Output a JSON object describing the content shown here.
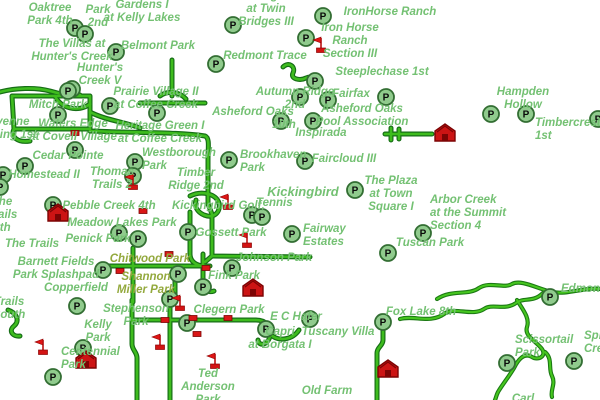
{
  "map": {
    "background": "#ffffff",
    "label_color": "#74c173",
    "label_color_olive": "#93a93d",
    "road_core_color": "#3ebc1e",
    "road_casing_color": "#166e16",
    "parking_icon": {
      "glyph": "P",
      "fill": "#90cb8d",
      "border": "#336e33",
      "letter_color": "#0a0a0a"
    },
    "marker_red": "#d91717",
    "marker_dark_red": "#7c0404",
    "labels": [
      {
        "text": "Oaktree\nPark 4th",
        "x": 50,
        "y": 2
      },
      {
        "text": "Oaktree\nPark\n2nd",
        "x": 98,
        "y": -9
      },
      {
        "text": "Gardens I\nat Kelly Lakes",
        "x": 142,
        "y": -1
      },
      {
        "text": "Village\nat Twin\nBridges III",
        "x": 266,
        "y": -10
      },
      {
        "text": "IronHorse Ranch",
        "x": 390,
        "y": 6
      },
      {
        "text": "The Villas at\nHunter's Creek",
        "x": 72,
        "y": 38
      },
      {
        "text": "Belmont Park",
        "x": 158,
        "y": 40
      },
      {
        "text": "Iron Horse\nRanch\nSection III",
        "x": 350,
        "y": 22
      },
      {
        "text": "Redmont Trace",
        "x": 265,
        "y": 50
      },
      {
        "text": "Hunter's\nCreek V",
        "x": 100,
        "y": 62
      },
      {
        "text": "Steeplechase 1st",
        "x": 382,
        "y": 66
      },
      {
        "text": "Prairie Village II\nat Coffee Creek",
        "x": 156,
        "y": 86
      },
      {
        "text": "Autumn Ridge\n2nd",
        "x": 295,
        "y": 86
      },
      {
        "text": "Fairfax",
        "x": 351,
        "y": 88
      },
      {
        "text": "Hampden\nHollow",
        "x": 523,
        "y": 86
      },
      {
        "text": "Mitch Park",
        "x": 58,
        "y": 99
      },
      {
        "text": "Cheyenne\nCrossing 1st",
        "x": 2,
        "y": 116
      },
      {
        "text": "Waters Edge\nat Covell Village",
        "x": 73,
        "y": 118
      },
      {
        "text": "Heritage Green I\nat Coffee Creek",
        "x": 160,
        "y": 120
      },
      {
        "text": "Asheford Oaks",
        "x": 253,
        "y": 106
      },
      {
        "text": "10th",
        "x": 284,
        "y": 119
      },
      {
        "text": "Asheford Oaks\nPool Association",
        "x": 362,
        "y": 103
      },
      {
        "text": "Inspirada",
        "x": 321,
        "y": 127
      },
      {
        "text": "Timbercrest\n1st",
        "x": 535,
        "y": 117,
        "align": "left"
      },
      {
        "text": "Cedar Pointe",
        "x": 68,
        "y": 150
      },
      {
        "text": "Westborough\nPark",
        "x": 142,
        "y": 147,
        "align": "left"
      },
      {
        "text": "Brookhaven\nPark",
        "x": 240,
        "y": 149,
        "align": "left"
      },
      {
        "text": "Faircloud III",
        "x": 344,
        "y": 153
      },
      {
        "text": "Homestead II",
        "x": 44,
        "y": 169
      },
      {
        "text": "Thomas\nTrails 2",
        "x": 112,
        "y": 166
      },
      {
        "text": "Timber\nRidge 2nd",
        "x": 196,
        "y": 167
      },
      {
        "text": "The Plaza\nat Town\nSquare I",
        "x": 391,
        "y": 175
      },
      {
        "text": "Arbor Creek\nat the Summit\nSection 4",
        "x": 430,
        "y": 194,
        "align": "left"
      },
      {
        "text": "The\nTrails\n5th",
        "x": 2,
        "y": 196
      },
      {
        "text": "Kickingbird",
        "x": 303,
        "y": 185,
        "size": 13
      },
      {
        "text": "Pebble Creek 4th",
        "x": 109,
        "y": 200
      },
      {
        "text": "Kickingbird Golf,",
        "x": 172,
        "y": 200,
        "align": "left"
      },
      {
        "text": "Tennis",
        "x": 256,
        "y": 197,
        "align": "left"
      },
      {
        "text": "Meadow Lakes Park",
        "x": 122,
        "y": 217
      },
      {
        "text": "Penick Park",
        "x": 98,
        "y": 233
      },
      {
        "text": "The Trails",
        "x": 32,
        "y": 238
      },
      {
        "text": "Gossett Park",
        "x": 231,
        "y": 227
      },
      {
        "text": "Fairway\nEstates",
        "x": 303,
        "y": 223,
        "align": "left"
      },
      {
        "text": "Chitwood Park",
        "x": 150,
        "y": 253,
        "color": "olive"
      },
      {
        "text": "Johnson Park",
        "x": 274,
        "y": 252
      },
      {
        "text": "Barnett Fields\nPark Splashpad",
        "x": 56,
        "y": 256
      },
      {
        "text": "Shannon\nMiller Park",
        "x": 146,
        "y": 271,
        "color": "olive"
      },
      {
        "text": "Fink Park",
        "x": 234,
        "y": 270
      },
      {
        "text": "Copperfield",
        "x": 76,
        "y": 282
      },
      {
        "text": "Tuscan Park",
        "x": 430,
        "y": 237
      },
      {
        "text": "Trails\nSouth",
        "x": 9,
        "y": 296
      },
      {
        "text": "Stephenson\nPark",
        "x": 136,
        "y": 303
      },
      {
        "text": "Kelly\nPark",
        "x": 98,
        "y": 319
      },
      {
        "text": "Centennial\nPark",
        "x": 61,
        "y": 346,
        "align": "left"
      },
      {
        "text": "Clegern Park",
        "x": 229,
        "y": 304
      },
      {
        "text": "E C Hafer",
        "x": 296,
        "y": 311
      },
      {
        "text": "Capri\nat Borgata I",
        "x": 280,
        "y": 326
      },
      {
        "text": "Tuscany Villa",
        "x": 338,
        "y": 326
      },
      {
        "text": "Old Farm",
        "x": 327,
        "y": 385
      },
      {
        "text": "Ted\nAnderson\nPark",
        "x": 208,
        "y": 368
      },
      {
        "text": "Fox Lake 8th",
        "x": 421,
        "y": 306
      },
      {
        "text": "Scissortail\nPark",
        "x": 515,
        "y": 334,
        "align": "left"
      },
      {
        "text": "Spring\nCreek",
        "x": 584,
        "y": 330,
        "align": "left"
      },
      {
        "text": "Edmond",
        "x": 561,
        "y": 283,
        "align": "left"
      },
      {
        "text": "Carl",
        "x": 523,
        "y": 393
      }
    ],
    "parking_icons": [
      [
        75,
        28
      ],
      [
        85,
        34
      ],
      [
        116,
        52
      ],
      [
        72,
        89
      ],
      [
        233,
        25
      ],
      [
        323,
        16
      ],
      [
        306,
        38
      ],
      [
        216,
        64
      ],
      [
        315,
        81
      ],
      [
        300,
        97
      ],
      [
        328,
        100
      ],
      [
        386,
        97
      ],
      [
        281,
        121
      ],
      [
        313,
        121
      ],
      [
        68,
        91
      ],
      [
        110,
        106
      ],
      [
        157,
        113
      ],
      [
        58,
        115
      ],
      [
        75,
        150
      ],
      [
        25,
        166
      ],
      [
        3,
        175
      ],
      [
        0,
        187
      ],
      [
        135,
        162
      ],
      [
        133,
        176
      ],
      [
        229,
        160
      ],
      [
        305,
        161
      ],
      [
        355,
        190
      ],
      [
        491,
        114
      ],
      [
        526,
        114
      ],
      [
        598,
        119
      ],
      [
        53,
        205
      ],
      [
        119,
        233
      ],
      [
        138,
        239
      ],
      [
        188,
        232
      ],
      [
        103,
        270
      ],
      [
        178,
        274
      ],
      [
        252,
        215
      ],
      [
        262,
        217
      ],
      [
        292,
        234
      ],
      [
        232,
        268
      ],
      [
        203,
        287
      ],
      [
        388,
        253
      ],
      [
        423,
        233
      ],
      [
        550,
        297
      ],
      [
        77,
        306
      ],
      [
        170,
        299
      ],
      [
        187,
        323
      ],
      [
        83,
        348
      ],
      [
        53,
        377
      ],
      [
        310,
        319
      ],
      [
        266,
        329
      ],
      [
        383,
        322
      ],
      [
        507,
        363
      ],
      [
        574,
        361
      ]
    ],
    "flag_icons": [
      [
        321,
        46
      ],
      [
        133,
        183
      ],
      [
        228,
        203
      ],
      [
        247,
        241
      ],
      [
        180,
        304
      ],
      [
        160,
        343
      ],
      [
        43,
        348
      ],
      [
        215,
        362
      ]
    ],
    "school_icons": [
      [
        445,
        133
      ],
      [
        58,
        213
      ],
      [
        253,
        288
      ],
      [
        86,
        360
      ],
      [
        388,
        369
      ]
    ],
    "rect_markers": [
      [
        75,
        133
      ],
      [
        143,
        211
      ],
      [
        169,
        254
      ],
      [
        120,
        271
      ],
      [
        206,
        268
      ],
      [
        165,
        320
      ],
      [
        193,
        318
      ],
      [
        228,
        318
      ],
      [
        197,
        334
      ]
    ],
    "roads": [
      {
        "d": "M0,92 C15,88 35,87 50,91 C60,94 70,96 80,95"
      },
      {
        "d": "M12,96 L90,96 L90,129 L14,129 Z"
      },
      {
        "d": "M55,96 C60,108 78,113 90,104"
      },
      {
        "d": "M90,112 C105,120 125,122 140,128"
      },
      {
        "d": "M14,129 C10,137 18,143 30,141"
      },
      {
        "d": "M90,131 C140,133 180,132 205,136 C210,138 208,148 208,158 L208,204"
      },
      {
        "d": "M140,103 L205,103"
      },
      {
        "d": "M160,96 C168,90 180,92 186,99"
      },
      {
        "d": "M172,60 L172,96"
      },
      {
        "d": "M208,204 L212,214 L212,256 L310,257"
      },
      {
        "d": "M212,256 L205,262"
      },
      {
        "d": "M190,196 C202,190 216,194 219,203 C221,212 214,219 204,215 C197,212 194,206 196,200"
      },
      {
        "d": "M190,212 L190,254 C190,262 197,266 205,266"
      },
      {
        "d": "M100,266 L210,266"
      },
      {
        "d": "M133,248 L133,302"
      },
      {
        "d": "M203,254 L203,284 C203,290 209,293 214,291"
      },
      {
        "d": "M175,266 L175,296"
      },
      {
        "d": "M132,300 L132,344 C132,350 137,352 137,358 L137,400"
      },
      {
        "d": "M170,294 L170,400"
      },
      {
        "d": "M133,320 L256,320 C266,320 272,327 270,336 C268,345 259,347 258,340"
      },
      {
        "d": "M270,334 C279,343 293,339 299,330"
      },
      {
        "d": "M383,321 L383,340 C383,346 377,347 377,353 L377,400"
      },
      {
        "d": "M385,134 L432,134"
      },
      {
        "d": "M391,128 L391,140"
      },
      {
        "d": "M399,129 L399,139"
      },
      {
        "d": "M283,67 C289,61 296,67 293,73 C290,79 300,81 306,78 C313,75 313,80 317,83"
      },
      {
        "d": "M8,310 C17,313 20,321 14,326 C8,331 13,337 20,336"
      }
    ],
    "creeks": [
      {
        "d": "M437,299 C452,289 468,296 479,288 C490,281 504,289 512,284 C521,279 538,289 552,292 C568,295 584,287 600,289"
      },
      {
        "d": "M543,293 C533,303 524,297 516,303 C505,311 492,303 484,309 C472,317 454,306 444,314 C430,324 414,315 400,319"
      },
      {
        "d": "M517,300 C523,310 530,318 527,327 C524,336 536,341 542,349 C547,356 538,361 532,357 C524,352 518,360 514,368 C508,378 502,385 498,392 C496,396 496,398 495,400"
      },
      {
        "d": "M545,352 C553,359 548,368 552,376 C556,384 550,390 552,397"
      }
    ]
  }
}
